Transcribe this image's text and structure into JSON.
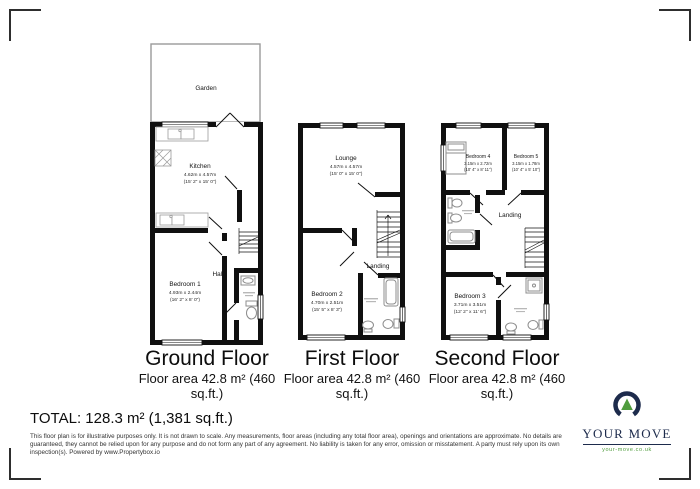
{
  "ground_floor": {
    "title": "Ground Floor",
    "area_line1": "Floor area 42.8 m² (460",
    "area_line2": "sq.ft.)",
    "garden_label": "Garden",
    "hall_label": "Hall",
    "kitchen": {
      "name": "Kitchen",
      "metric": "4.62m x 4.57m",
      "imperial": "(15' 2\" x 15' 0\")"
    },
    "bedroom1": {
      "name": "Bedroom 1",
      "metric": "4.93m x 2.44m",
      "imperial": "(16' 2\" x 8' 0\")"
    }
  },
  "first_floor": {
    "title": "First Floor",
    "area_line1": "Floor area 42.8 m² (460",
    "area_line2": "sq.ft.)",
    "landing_label": "Landing",
    "lounge": {
      "name": "Lounge",
      "metric": "4.57m x 4.57m",
      "imperial": "(15' 0\" x 15' 0\")"
    },
    "bedroom2": {
      "name": "Bedroom 2",
      "metric": "4.70m x 2.51m",
      "imperial": "(15' 5\" x 8' 3\")"
    }
  },
  "second_floor": {
    "title": "Second Floor",
    "area_line1": "Floor area 42.8 m² (460",
    "area_line2": "sq.ft.)",
    "landing_label": "Landing",
    "bedroom4": {
      "name": "Bedroom 4",
      "metric": "3.15m x 2.72m",
      "imperial": "(10' 4\" x 8' 11\")"
    },
    "bedroom5": {
      "name": "Bedroom 5",
      "metric": "3.15m x 1.78m",
      "imperial": "(10' 4\" x 5' 10\")"
    },
    "bedroom3": {
      "name": "Bedroom 3",
      "metric": "3.71m x 3.51m",
      "imperial": "(12' 2\" x 11' 6\")"
    }
  },
  "total_label": "TOTAL: 128.3 m² (1,381 sq.ft.)",
  "disclaimer": "This floor plan is for illustrative purposes only. It is not drawn to scale. Any measurements, floor areas (including any total floor area), openings and orientations are approximate. No details are guaranteed, they cannot be relied upon for any purpose and do not form any part of any agreement. No liability is taken for any error, omission or misstatement. A party must rely upon its own inspection(s). Powered by www.Propertybox.io",
  "logo": {
    "brand": "YOUR MOVE",
    "website": "your-move.co.uk",
    "navy": "#1d2b4c",
    "green": "#4f9c3d"
  }
}
